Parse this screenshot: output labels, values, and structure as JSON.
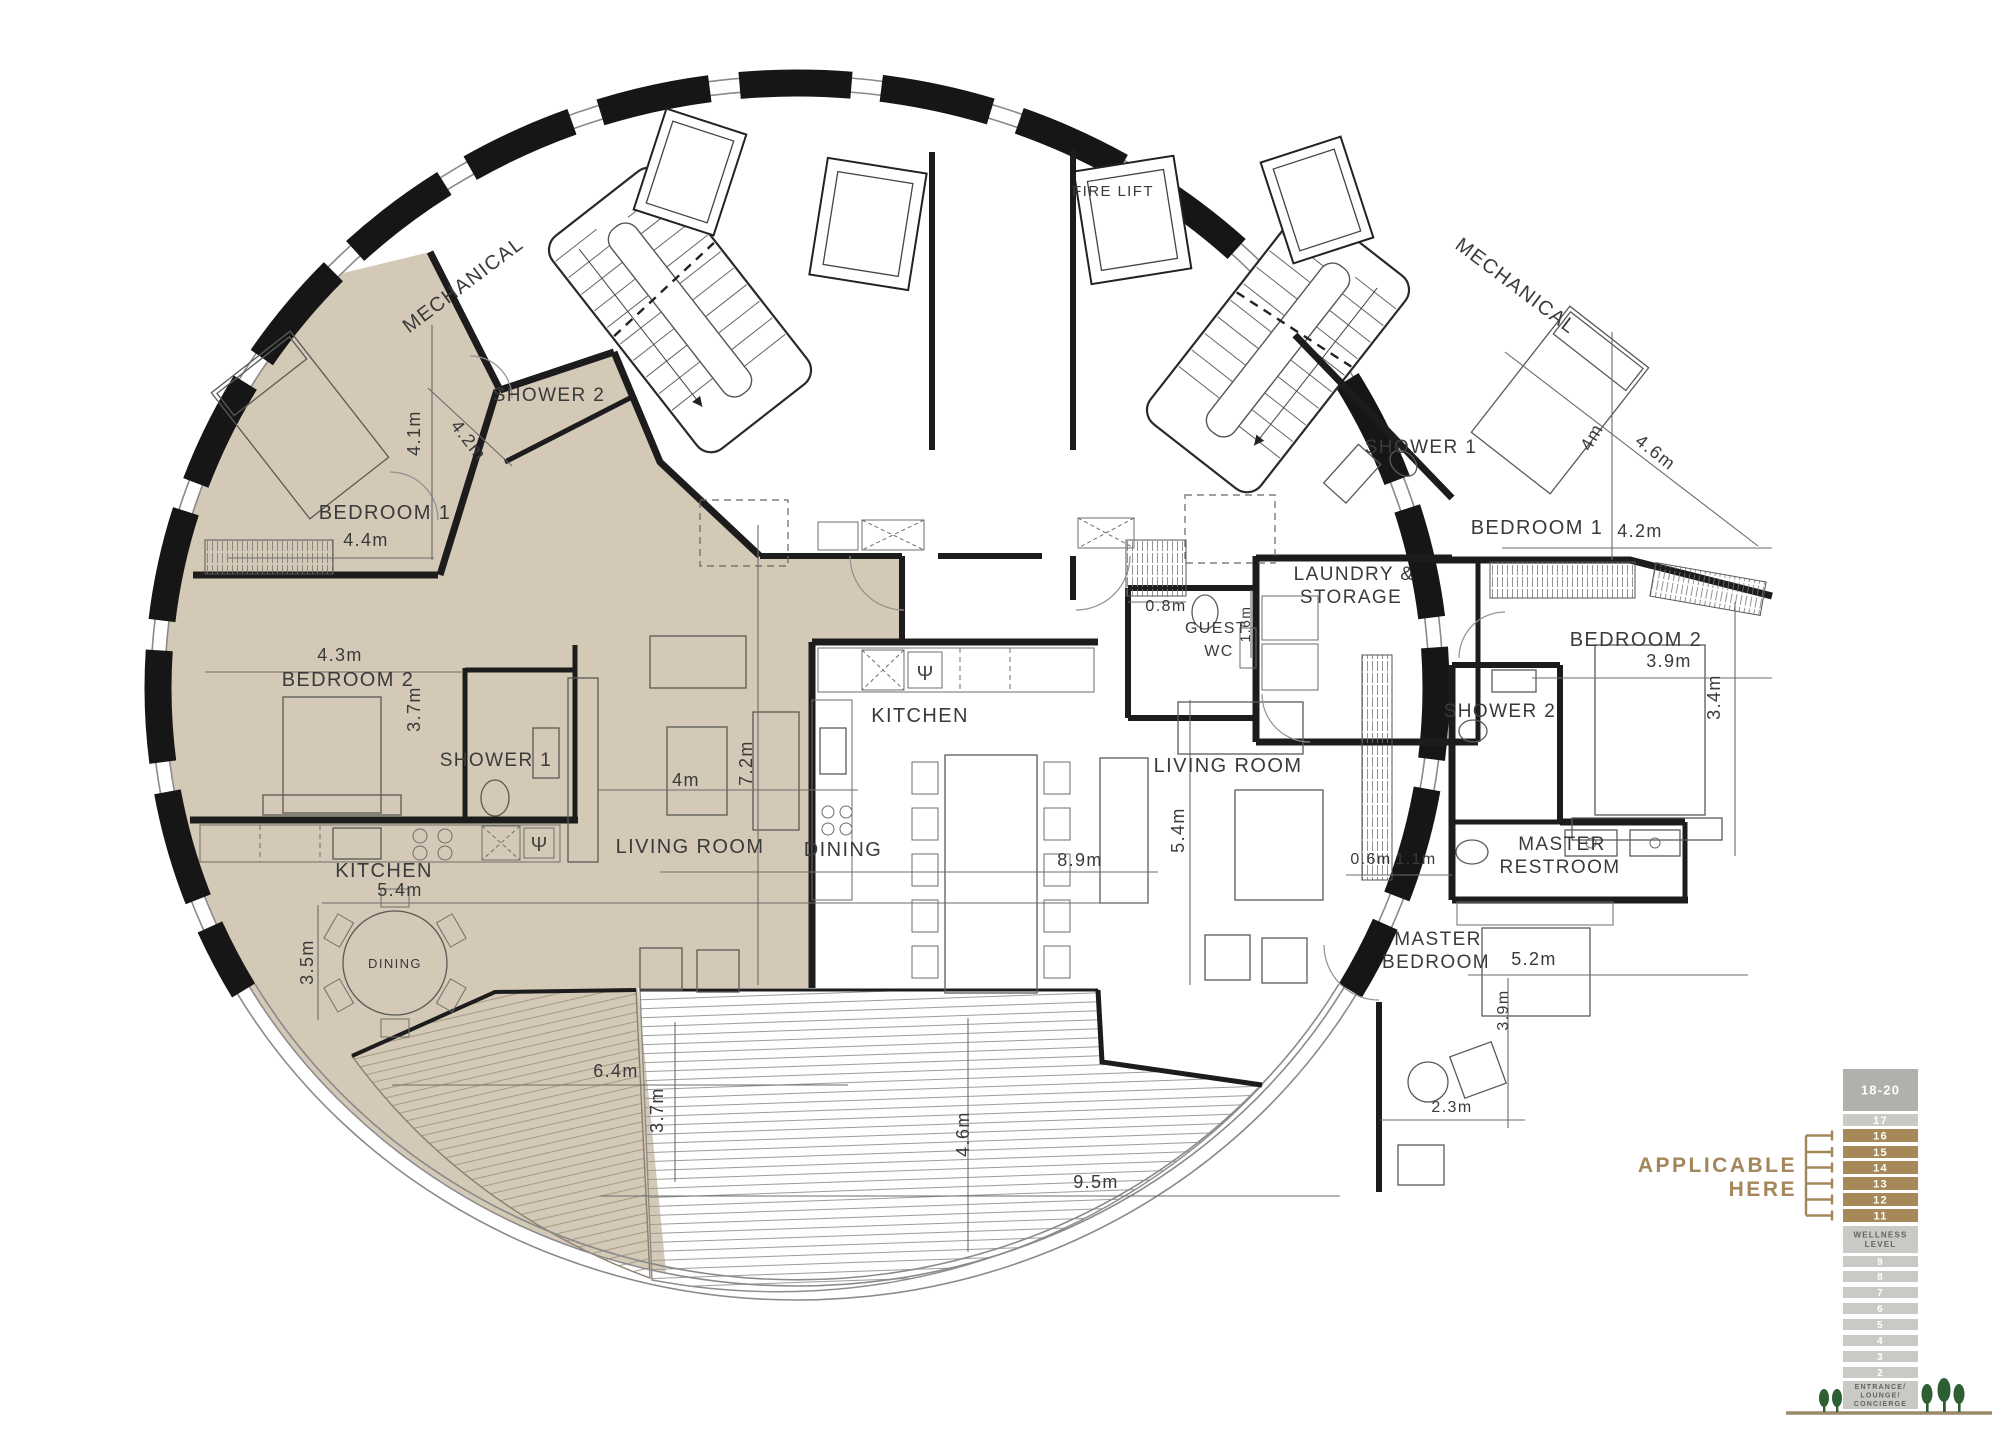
{
  "page": {
    "title": "Elliptical penthouse floor plan"
  },
  "colors": {
    "tan": "#d4c8b6",
    "tan_line": "#a69a84",
    "wall": "#1c1c1c",
    "window_line": "#8a8a8a",
    "dim_line": "#6b6b6b",
    "text": "#3a3a3a",
    "deck_line": "#9c9c98",
    "accent": "#a3875a",
    "legend_dark": "#b0b0ac",
    "legend_light": "#c9c9c5",
    "legend_brown": "#a78959",
    "legend_label_text": "#63635e",
    "tree_green": "#2e5f33",
    "ground": "#9b8a6d"
  },
  "plan": {
    "labels": [
      {
        "t": "MECHANICAL",
        "x": 467,
        "y": 290,
        "r": -37,
        "fs": 20
      },
      {
        "t": "SHOWER 2",
        "x": 549,
        "y": 401,
        "r": 0,
        "fs": 19
      },
      {
        "t": "4.1m",
        "x": 420,
        "y": 433,
        "r": -90,
        "fs": 18
      },
      {
        "t": "4.2m",
        "x": 464,
        "y": 444,
        "r": 52,
        "fs": 18
      },
      {
        "t": "BEDROOM 1",
        "x": 385,
        "y": 519,
        "r": 0,
        "fs": 20
      },
      {
        "t": "4.4m",
        "x": 366,
        "y": 546,
        "r": 0,
        "fs": 18
      },
      {
        "t": "4.3m",
        "x": 340,
        "y": 661,
        "r": 0,
        "fs": 18
      },
      {
        "t": "BEDROOM 2",
        "x": 348,
        "y": 686,
        "r": 0,
        "fs": 20
      },
      {
        "t": "3.7m",
        "x": 420,
        "y": 709,
        "r": -90,
        "fs": 18
      },
      {
        "t": "SHOWER 1",
        "x": 496,
        "y": 766,
        "r": 0,
        "fs": 19
      },
      {
        "t": "4m",
        "x": 686,
        "y": 786,
        "r": 0,
        "fs": 18
      },
      {
        "t": "7.2m",
        "x": 752,
        "y": 763,
        "r": -90,
        "fs": 18
      },
      {
        "t": "LIVING ROOM",
        "x": 690,
        "y": 853,
        "r": 0,
        "fs": 20
      },
      {
        "t": "KITCHEN",
        "x": 384,
        "y": 877,
        "r": 0,
        "fs": 20
      },
      {
        "t": "5.4m",
        "x": 400,
        "y": 896,
        "r": 0,
        "fs": 18
      },
      {
        "t": "3.5m",
        "x": 313,
        "y": 962,
        "r": -90,
        "fs": 18
      },
      {
        "t": "DINING",
        "x": 395,
        "y": 968,
        "r": 0,
        "fs": 13
      },
      {
        "t": "6.4m",
        "x": 616,
        "y": 1077,
        "r": 0,
        "fs": 18
      },
      {
        "t": "3.7m",
        "x": 663,
        "y": 1110,
        "r": -90,
        "fs": 18
      },
      {
        "t": "FIRE LIFT",
        "x": 1113,
        "y": 196,
        "r": 0,
        "fs": 15
      },
      {
        "t": "MECHANICAL",
        "x": 1512,
        "y": 291,
        "r": 37,
        "fs": 20
      },
      {
        "t": "SHOWER 1",
        "x": 1421,
        "y": 453,
        "r": 0,
        "fs": 19
      },
      {
        "t": "4m",
        "x": 1597,
        "y": 440,
        "r": -60,
        "fs": 18
      },
      {
        "t": "4.6m",
        "x": 1652,
        "y": 457,
        "r": 38,
        "fs": 18
      },
      {
        "t": "BEDROOM 1",
        "x": 1537,
        "y": 534,
        "r": 0,
        "fs": 20
      },
      {
        "t": "4.2m",
        "x": 1640,
        "y": 537,
        "r": 0,
        "fs": 18
      },
      {
        "t": "LAUNDRY &",
        "x": 1354,
        "y": 580,
        "r": 0,
        "fs": 19
      },
      {
        "t": "STORAGE",
        "x": 1351,
        "y": 603,
        "r": 0,
        "fs": 19
      },
      {
        "t": "0.8m",
        "x": 1166,
        "y": 611,
        "r": 0,
        "fs": 16
      },
      {
        "t": "GUEST",
        "x": 1216,
        "y": 633,
        "r": 0,
        "fs": 16
      },
      {
        "t": "WC",
        "x": 1219,
        "y": 656,
        "r": 0,
        "fs": 16
      },
      {
        "t": "1.6m",
        "x": 1250,
        "y": 624,
        "r": -90,
        "fs": 14
      },
      {
        "t": "BEDROOM 2",
        "x": 1636,
        "y": 646,
        "r": 0,
        "fs": 20
      },
      {
        "t": "3.9m",
        "x": 1669,
        "y": 667,
        "r": 0,
        "fs": 18
      },
      {
        "t": "SHOWER 2",
        "x": 1500,
        "y": 717,
        "r": 0,
        "fs": 19
      },
      {
        "t": "3.4m",
        "x": 1720,
        "y": 697,
        "r": -90,
        "fs": 18
      },
      {
        "t": "KITCHEN",
        "x": 920,
        "y": 722,
        "r": 0,
        "fs": 20
      },
      {
        "t": "LIVING ROOM",
        "x": 1228,
        "y": 772,
        "r": 0,
        "fs": 20
      },
      {
        "t": "5.4m",
        "x": 1184,
        "y": 830,
        "r": -90,
        "fs": 18
      },
      {
        "t": "DINING",
        "x": 843,
        "y": 856,
        "r": 0,
        "fs": 20
      },
      {
        "t": "8.9m",
        "x": 1080,
        "y": 866,
        "r": 0,
        "fs": 18
      },
      {
        "t": "0.6m",
        "x": 1371,
        "y": 864,
        "r": 0,
        "fs": 16
      },
      {
        "t": "1.1m",
        "x": 1416,
        "y": 864,
        "r": 0,
        "fs": 16
      },
      {
        "t": "MASTER",
        "x": 1562,
        "y": 850,
        "r": 0,
        "fs": 19
      },
      {
        "t": "RESTROOM",
        "x": 1560,
        "y": 873,
        "r": 0,
        "fs": 19
      },
      {
        "t": "MASTER",
        "x": 1438,
        "y": 945,
        "r": 0,
        "fs": 19
      },
      {
        "t": "BEDROOM",
        "x": 1436,
        "y": 968,
        "r": 0,
        "fs": 19
      },
      {
        "t": "5.2m",
        "x": 1534,
        "y": 965,
        "r": 0,
        "fs": 18
      },
      {
        "t": "3.9m",
        "x": 1508,
        "y": 1010,
        "r": -90,
        "fs": 16
      },
      {
        "t": "2.3m",
        "x": 1452,
        "y": 1112,
        "r": 0,
        "fs": 16
      },
      {
        "t": "4.6m",
        "x": 969,
        "y": 1134,
        "r": -90,
        "fs": 18
      },
      {
        "t": "9.5m",
        "x": 1096,
        "y": 1188,
        "r": 0,
        "fs": 18
      }
    ]
  },
  "legend": {
    "x": 1843,
    "w": 75,
    "rows": [
      {
        "t": "18-20",
        "y": 1069,
        "h": 42,
        "c": "dark",
        "fs": 13
      },
      {
        "t": "17",
        "y": 1114,
        "h": 12,
        "c": "light",
        "fs": 11
      },
      {
        "t": "16",
        "y": 1129,
        "h": 13,
        "c": "brown",
        "fs": 11
      },
      {
        "t": "15",
        "y": 1146,
        "h": 12,
        "c": "brown",
        "fs": 11
      },
      {
        "t": "14",
        "y": 1161,
        "h": 13,
        "c": "brown",
        "fs": 11
      },
      {
        "t": "13",
        "y": 1177,
        "h": 13,
        "c": "brown",
        "fs": 11
      },
      {
        "t": "12",
        "y": 1193,
        "h": 13,
        "c": "brown",
        "fs": 11
      },
      {
        "t": "11",
        "y": 1209,
        "h": 13,
        "c": "brown",
        "fs": 11
      },
      {
        "t": "WELLNESS\nLEVEL",
        "y": 1226,
        "h": 27,
        "c": "label",
        "fs": 8
      },
      {
        "t": "9",
        "y": 1256,
        "h": 11,
        "c": "light",
        "fs": 10
      },
      {
        "t": "8",
        "y": 1271,
        "h": 11,
        "c": "light",
        "fs": 10
      },
      {
        "t": "7",
        "y": 1287,
        "h": 11,
        "c": "light",
        "fs": 10
      },
      {
        "t": "6",
        "y": 1303,
        "h": 11,
        "c": "light",
        "fs": 10
      },
      {
        "t": "5",
        "y": 1319,
        "h": 11,
        "c": "light",
        "fs": 10
      },
      {
        "t": "4",
        "y": 1335,
        "h": 11,
        "c": "light",
        "fs": 10
      },
      {
        "t": "3",
        "y": 1351,
        "h": 11,
        "c": "light",
        "fs": 10
      },
      {
        "t": "2",
        "y": 1367,
        "h": 11,
        "c": "light",
        "fs": 10
      },
      {
        "t": "ENTRANCE/\nLOUNGE/\nCONCIERGE",
        "y": 1381,
        "h": 28,
        "c": "label",
        "fs": 7
      }
    ],
    "applicable": {
      "lines": [
        "APPLICABLE",
        "HERE"
      ],
      "x": 1797,
      "y1": 1172,
      "y2": 1196,
      "fs": 21
    }
  }
}
